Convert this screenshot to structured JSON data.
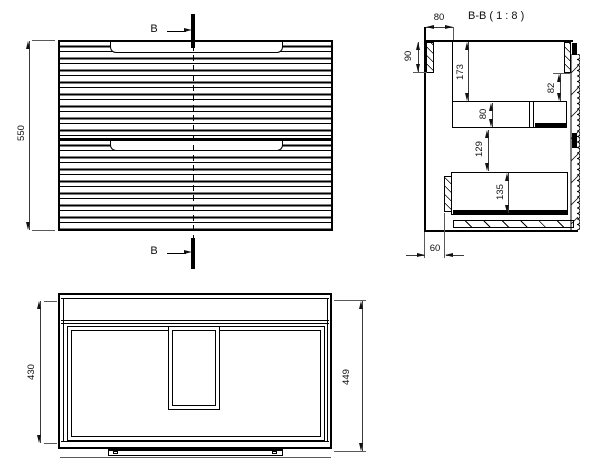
{
  "drawing": {
    "front_view": {
      "dim_height": "550",
      "marker_top": "B",
      "marker_bottom": "B"
    },
    "section_view": {
      "title": "B-B ( 1 : 8 )",
      "dim_top_depth": "80",
      "dim_rail": "90",
      "dim_top_gap": "173",
      "dim_front_gap": "82",
      "dim_shelf": "80",
      "dim_mid_gap": "129",
      "dim_drawer": "135",
      "dim_back": "60"
    },
    "plan_view": {
      "dim_inner_depth": "430",
      "dim_total_depth": "449"
    }
  }
}
